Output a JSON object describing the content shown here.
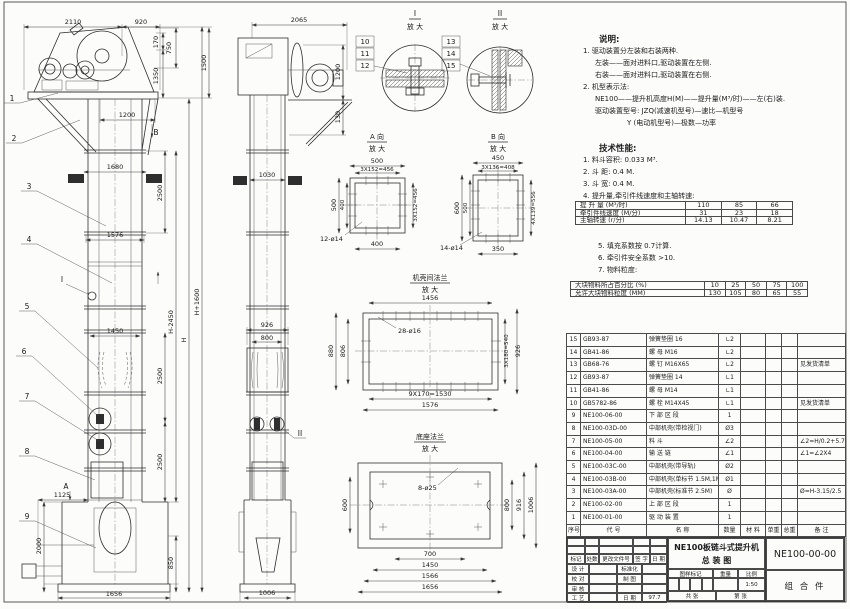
{
  "dwg": {
    "f2110": "2110",
    "f920": "920",
    "f170": "170",
    "f750": "750",
    "f1350": "1350",
    "f1500": "1500",
    "f1200": "1200",
    "f1680": "1680",
    "f2500a": "2500",
    "f1576": "1576",
    "fH2450": "H-2450",
    "fH": "H",
    "fH1600": "H+1600",
    "f1450": "1450",
    "f2500b": "2500",
    "f2500c": "2500",
    "f1125": "1125",
    "f2000": "2000",
    "f850": "850",
    "f1656": "1656",
    "fB": "B",
    "fI": "I",
    "fA": "A",
    "b1": "1",
    "b2": "2",
    "b3": "3",
    "b4": "4",
    "b5": "5",
    "b6": "6",
    "b7": "7",
    "b8": "8",
    "b9": "9",
    "b10": "10",
    "b11": "11",
    "b12": "12",
    "b13": "13",
    "b14": "14",
    "b15": "15",
    "s2065": "2065",
    "s1200": "1200",
    "s130": "130",
    "s1030": "1030",
    "s926": "926",
    "s800": "800",
    "s1006": "1006",
    "sII": "II",
    "dI": "I",
    "dII": "II",
    "mag": "放 大",
    "vaT": "A 向",
    "vbT": "B 向",
    "a500t": "500",
    "aPt": "3X152=456",
    "a500l": "500",
    "a400l": "400",
    "aPr": "3X152=456",
    "a400b": "400",
    "aH": "12-ø14",
    "bv450": "450",
    "bvPt": "3X136=408",
    "bv600": "600",
    "bv500": "500",
    "bvPr": "4X139=556",
    "bv350": "350",
    "bvH": "14-ø14",
    "fmT": "机壳间法兰",
    "fm1456": "1456",
    "fmH": "28-ø16",
    "fm880": "880",
    "fm806": "806",
    "fm540": "3X180=540",
    "fm926": "926",
    "fm1530": "9X170=1530",
    "fm1576": "1576",
    "fbT": "底座法兰",
    "fbH": "8-ø25",
    "fb600": "600",
    "fb800": "800",
    "fb916": "916",
    "fb1006": "1006",
    "fb700": "700",
    "fb1450": "1450",
    "fb1566": "1566",
    "fb1656": "1656"
  },
  "notes": {
    "heading": "说明:",
    "lines": [
      "1. 驱动装置分左装和右装两种.",
      "左装——面对进料口,驱动装置在左侧.",
      "右装——面对进料口,驱动装置在右侧.",
      "2. 机型表示法:",
      "NE100——提升机高度H(M)——提升量(M³/时)——左(右)装.",
      "驱动装置型号: JZQ(减速机型号)—速比—机型号",
      "Y (电动机型号)—极数—功率"
    ]
  },
  "tech": {
    "heading": "技术性能:",
    "items": [
      "1. 料斗容积: 0.033 M³.",
      "2. 斗  距: 0.4 M.",
      "3. 斗  宽: 0.4 M.",
      "4. 提升量,牵引件线速度和主轴转速:"
    ],
    "items2": [
      "5. 填充系数按 0.7计算.",
      "6. 牵引件安全系数 >10.",
      "7. 物料粒度:"
    ]
  },
  "speed_table": {
    "rows": [
      [
        "提 升 量 (M³/时)",
        "110",
        "85",
        "66"
      ],
      [
        "牵引件线速度 (M/分)",
        "31",
        "23",
        "18"
      ],
      [
        "主轴转速 (r/分)",
        "14.13",
        "10.47",
        "8.21"
      ]
    ]
  },
  "size_table": {
    "rows": [
      [
        "大块物料所占百分比 (%)",
        "10",
        "25",
        "50",
        "75",
        "100"
      ],
      [
        "允许大块物料粒度 (MM)",
        "130",
        "105",
        "80",
        "65",
        "55"
      ]
    ]
  },
  "bom": {
    "headers": {
      "no": "序号",
      "code": "代  号",
      "name": "名  称",
      "qty": "数量",
      "mat": "材  料",
      "uw": "单重",
      "tw": "总重",
      "rem": "备 注"
    },
    "rows": [
      {
        "no": "15",
        "code": "GB93-87",
        "name": "弹簧垫圈  16",
        "qty": "∟2",
        "mat": "",
        "uw": "",
        "tw": "",
        "rem": ""
      },
      {
        "no": "14",
        "code": "GB41-86",
        "name": "螺 母  M16",
        "qty": "∟2",
        "mat": "",
        "uw": "",
        "tw": "",
        "rem": ""
      },
      {
        "no": "13",
        "code": "GB68-76",
        "name": "螺 钉  M16X65",
        "qty": "∟2",
        "mat": "",
        "uw": "",
        "tw": "",
        "rem": "见发货清单"
      },
      {
        "no": "12",
        "code": "GB93-87",
        "name": "弹簧垫圈  14",
        "qty": "∟1",
        "mat": "",
        "uw": "",
        "tw": "",
        "rem": ""
      },
      {
        "no": "11",
        "code": "GB41-86",
        "name": "螺 母  M14",
        "qty": "∟1",
        "mat": "",
        "uw": "",
        "tw": "",
        "rem": ""
      },
      {
        "no": "10",
        "code": "GB5782-86",
        "name": "螺 栓  M14X45",
        "qty": "∟1",
        "mat": "",
        "uw": "",
        "tw": "",
        "rem": "见发货清单"
      },
      {
        "no": "9",
        "code": "NE100-06-00",
        "name": "下 部 区 段",
        "qty": "1",
        "mat": "",
        "uw": "",
        "tw": "",
        "rem": ""
      },
      {
        "no": "8",
        "code": "NE100-03D-00",
        "name": "中部机壳(带检视门)",
        "qty": "Ø3",
        "mat": "",
        "uw": "",
        "tw": "",
        "rem": ""
      },
      {
        "no": "7",
        "code": "NE100-05-00",
        "name": "料  斗",
        "qty": "∠2",
        "mat": "",
        "uw": "",
        "tw": "",
        "rem": "∠2=H/0.2+5.75"
      },
      {
        "no": "6",
        "code": "NE100-04-00",
        "name": "输 送 链",
        "qty": "∠1",
        "mat": "",
        "uw": "",
        "tw": "",
        "rem": "∠1=∠2X4"
      },
      {
        "no": "5",
        "code": "NE100-03C-00",
        "name": "中部机壳(带导轨)",
        "qty": "Ø2",
        "mat": "",
        "uw": "",
        "tw": "",
        "rem": ""
      },
      {
        "no": "4",
        "code": "NE100-03B-00",
        "name": "中部机壳(单标节 1.5M,1M)",
        "qty": "Ø1",
        "mat": "",
        "uw": "",
        "tw": "",
        "rem": ""
      },
      {
        "no": "3",
        "code": "NE100-03A-00",
        "name": "中部机壳(标准节 2.5M)",
        "qty": "Ø",
        "mat": "",
        "uw": "",
        "tw": "",
        "rem": "Ø=H-3.15/2.5"
      },
      {
        "no": "2",
        "code": "NE100-02-00",
        "name": "上 部 区 段",
        "qty": "1",
        "mat": "",
        "uw": "",
        "tw": "",
        "rem": ""
      },
      {
        "no": "1",
        "code": "NE100-01-00",
        "name": "驱 动 装 置",
        "qty": "1",
        "mat": "",
        "uw": "",
        "tw": "",
        "rem": ""
      }
    ]
  },
  "titleblock": {
    "title1": "NE100板链斗式提升机",
    "title2": "总  装  图",
    "dwgno": "NE100-00-00",
    "assembly": "组 合 件",
    "mark": "标记",
    "count": "处数",
    "changefile": "更改文件号",
    "sign": "签 字",
    "date": "日 期",
    "design": "设 计",
    "check": "校 对",
    "review": "审 核",
    "craft": "工 艺",
    "std": "标准化",
    "draw": "制 图",
    "date_lbl": "日 期",
    "date_val": "97.7",
    "stamp": "图样标记",
    "weight": "重量",
    "scale_lbl": "比例",
    "scale": "1:50",
    "sheets": "共  张",
    "sheetno": "第  张"
  }
}
